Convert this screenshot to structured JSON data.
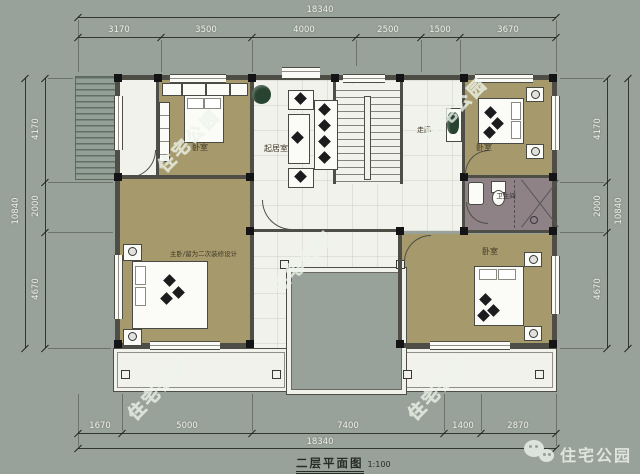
{
  "colors": {
    "background": "#99a29a",
    "bedroom_floor": "#a69a6c",
    "bathroom_floor": "#8e8287",
    "plan_white": "#f2f2ed",
    "watermark": "#e8f0e5"
  },
  "dims": {
    "top_total": "18340",
    "top_segments": [
      "3170",
      "3500",
      "4000",
      "2500",
      "1500",
      "3670"
    ],
    "bottom_segments": [
      "1670",
      "5000",
      "7400",
      "1400",
      "2870"
    ],
    "bottom_total": "18340",
    "left_total": "10840",
    "left_segments": [
      "4170",
      "2000",
      "4670"
    ],
    "right_total": "10840",
    "right_segments": [
      "4170",
      "2000",
      "4670"
    ]
  },
  "rooms": {
    "bedroom_top_left": "卧室",
    "living_room": "起居室",
    "hallway": "走廊",
    "bedroom_top_right": "卧室",
    "bathroom": "卫生间",
    "master_bedroom": "主卧/留为二次装修设计",
    "bedroom_bottom_right": "卧室"
  },
  "title": {
    "name": "二层平面图",
    "scale": "1:100"
  },
  "watermark": {
    "text": "住宅公园"
  },
  "logo": {
    "text": "住宅公园"
  }
}
